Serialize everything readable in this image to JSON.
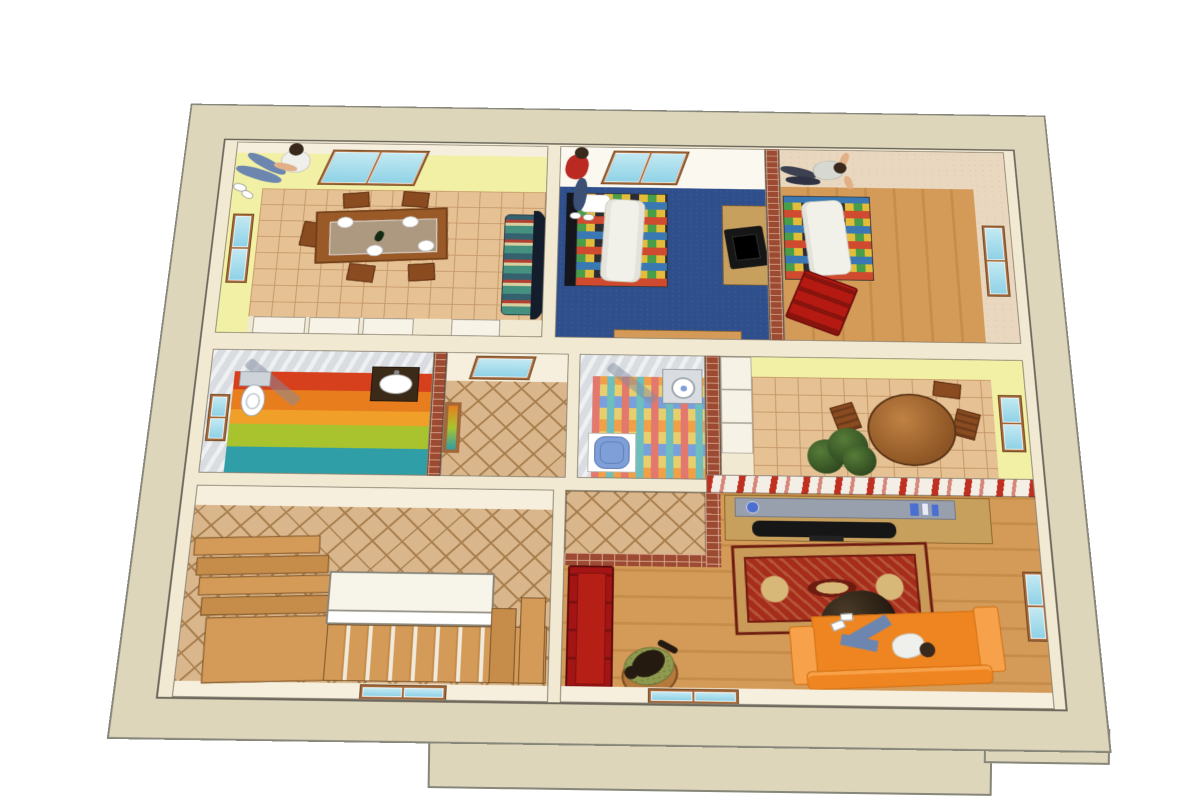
{
  "scene": {
    "title": "3D dollhouse floor plan, top-down cutaway render",
    "style": "sketchup-like architectural rendering",
    "text_on_screen": "none"
  },
  "colors": {
    "outer": "#ddd6bb",
    "outerEdge": "#87867a",
    "inner": "#f2e9d2",
    "yellow": "#f1f0a4",
    "cream": "#f6efdd",
    "beige": "#e9d8bf",
    "marble": "#d9dde1",
    "brick": "#9c4a32",
    "brickMortar": "#d8a88e",
    "tile": "#e5c193",
    "tileLine": "#c49564",
    "diamond": "#d9b68c",
    "diamondLine": "#a97f4e",
    "woodA": "#d49a58",
    "woodB": "#c68c49",
    "blueCarpet": "#2f4f8c",
    "glass": "#c2e9f2",
    "glassDark": "#8fd2e6",
    "frame": "#a3683a",
    "tableWood": "#9a5a28",
    "tableWoodDark": "#6e3c16",
    "chairWood": "#8a4b20",
    "sofaTeal": "#45907e",
    "sofaCream": "#d8cf9e",
    "sofaRed2": "#b04034",
    "sofaBack": "#141d2b",
    "quiltBase": "#e3bd3a",
    "quiltRed": "#cf4a2e",
    "quiltBlue": "#3a78b4",
    "quiltGreen": "#4a9e4a",
    "quiltDark": "#2c2c34",
    "duvet": "#f2f1e9",
    "skin": "#e2b088",
    "hair": "#39281c",
    "jeans": "#6c86b0",
    "jeansDark": "#3c4f74",
    "shirtRed": "#bb2a22",
    "shirtWhite": "#efefec",
    "tv": "#161616",
    "cabinet": "#c8a05e",
    "shelfGray": "#99a0ad",
    "bookBlue": "#4a6fd0",
    "redSofa": "#a31414",
    "rugField": "#a62c1c",
    "rugBorder": "#c99a58",
    "rugDark": "#6e1b10",
    "orange": "#ef8520",
    "orangeDark": "#d06f12",
    "orangeLight": "#f7a24a",
    "plantDark": "#2f4a20",
    "plantLight": "#567c38",
    "rainbow1": "#d6401c",
    "rainbow2": "#e87d1e",
    "rainbow3": "#f0a028",
    "rainbow4": "#a9c32e",
    "rainbow5": "#2f9ea6",
    "bath2base": "#e8cf6e",
    "bath2pink": "#e2786e",
    "bath2teal": "#6ebebe",
    "bath2orange": "#f0a046",
    "bath2blue": "#78a0dc",
    "toiletBlue": "#7f9fd8",
    "stoolWood": "#b5793c",
    "stoolGreen": "#8f9a4f",
    "cat": "#241a10",
    "halfwallBase": "#f3efe6",
    "halfwallRed": "#c03020",
    "showerGlass": "rgba(130,140,160,0.5)"
  },
  "rooms": [
    {
      "id": "dining-room",
      "label": "Dining room",
      "floor": "terracotta tile",
      "walls": "yellow",
      "features": [
        "skylight window",
        "left wall window",
        "wooden dining table with four white place settings",
        "wooden chairs",
        "teal patterned sofa with black curved back",
        "white sideboard cabinets along bottom wall"
      ]
    },
    {
      "id": "bedroom-blue",
      "label": "Bedroom with blue carpet",
      "floor": "blue carpet",
      "walls": "white",
      "features": [
        "skylight window",
        "bed with patchwork quilt and white duvet",
        "dark headboard",
        "wooden tv cabinet with television",
        "wooden bench at bottom wall"
      ]
    },
    {
      "id": "bedroom-right",
      "label": "Bedroom with wood floor",
      "floor": "vertical wood planks",
      "walls": "textured beige",
      "features": [
        "brick partition wall",
        "bed with patchwork quilt and white duvet",
        "red armchair",
        "right wall window"
      ]
    },
    {
      "id": "bathroom-rainbow",
      "label": "Bathroom with rainbow floor",
      "floor": "rainbow stripes",
      "walls": "gray marble",
      "features": [
        "white corner shower with glass door",
        "toilet with silver cistern",
        "dark vanity sink",
        "left wall window"
      ]
    },
    {
      "id": "landing-hall",
      "label": "Small landing",
      "floor": "diamond tiles",
      "walls": "cream",
      "features": [
        "skylight window",
        "rainbow glass door panel to bathroom"
      ]
    },
    {
      "id": "bathroom-small",
      "label": "Small bathroom",
      "floor": "multicolor mosaic tiles",
      "walls": "gray marble",
      "features": [
        "white corner shower",
        "stone wall sink with round basin",
        "blue toilet"
      ]
    },
    {
      "id": "breakfast-corridor",
      "label": "Breakfast corridor",
      "floor": "terracotta tile",
      "walls": "yellow",
      "features": [
        "white wardrobe",
        "round wooden table",
        "wooden chairs",
        "green potted plant",
        "right wall window",
        "red flower-box half wall"
      ]
    },
    {
      "id": "stair-hall",
      "label": "Stair hall",
      "floor": "diamond tiles",
      "walls": "cream",
      "features": [
        "wooden winder steps",
        "white landing balustrade",
        "straight wooden flight",
        "bottom wall window"
      ]
    },
    {
      "id": "living-room",
      "label": "Living room",
      "floor": "horizontal wood planks",
      "walls": "cream",
      "features": [
        "tiled vestibule with brick walls",
        "red sofa",
        "oriental red rug",
        "brown beanbag",
        "orange sofa",
        "gray shelf with blue books",
        "black television on sideboard",
        "cat on green stool",
        "right wall window",
        "bottom wall window"
      ]
    }
  ],
  "people": [
    {
      "location": "dining-room",
      "pose": "sitting on patterned sofa",
      "clothes": "white t-shirt, blue jeans, white sneakers"
    },
    {
      "location": "bedroom-blue",
      "pose": "sitting on edge of bed",
      "clothes": "red top, dark jeans, white shoes"
    },
    {
      "location": "bedroom-right",
      "pose": "standing at the window",
      "clothes": "light gray top, dark trousers"
    },
    {
      "location": "living-room",
      "pose": "lying on orange sofa",
      "clothes": "white t-shirt, blue jeans"
    }
  ],
  "pets": [
    {
      "type": "cat",
      "color": "dark brown",
      "location": "green cushioned stool in living room"
    }
  ]
}
